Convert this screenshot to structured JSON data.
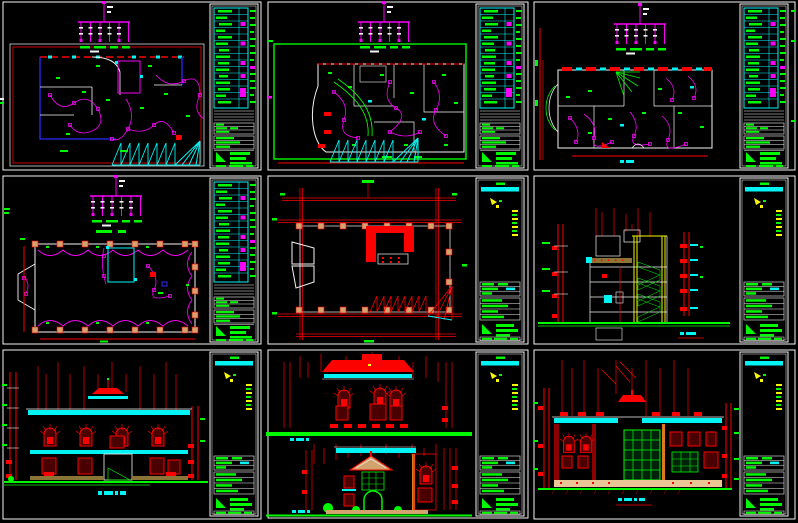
{
  "app": {
    "description": "Tiled preview of nine architectural CAD sheets (villa electrical plans, roof plan, section and elevations) on a black model-space background",
    "grid": {
      "rows": 3,
      "cols": 3,
      "cell_width": 266,
      "cell_height": 174
    }
  },
  "palette": {
    "background": "#000000",
    "white": "#f4f4f4",
    "red": "#fb0200",
    "green": "#00f800",
    "magenta": "#f800f8",
    "cyan": "#00f4f4",
    "blue": "#2a2aff",
    "yellow": "#f8f800",
    "tan": "#d2a36c",
    "peach": "#eac husband",
    "orange": "#e07820",
    "brown": "#8b7536",
    "gray": "#8f8f8f",
    "dark_red": "#8b0000",
    "brick_line": "#c04000",
    "window_dark": "#4a0000",
    "glass_dark": "#00220a"
  },
  "sheets": [
    {
      "id": "sheet-1",
      "row": 1,
      "col": 1,
      "drawing": "floor-lighting-plan-1",
      "title_block": "dense",
      "riser_diagram": true,
      "legend_rows": 15
    },
    {
      "id": "sheet-2",
      "row": 1,
      "col": 2,
      "drawing": "floor-lighting-plan-2",
      "title_block": "dense",
      "riser_diagram": true,
      "legend_rows": 15
    },
    {
      "id": "sheet-3",
      "row": 1,
      "col": 3,
      "drawing": "floor-lighting-plan-3",
      "title_block": "dense",
      "riser_diagram": true,
      "legend_rows": 15
    },
    {
      "id": "sheet-4",
      "row": 2,
      "col": 1,
      "drawing": "roof-lightning-protection-plan",
      "title_block": "dense",
      "riser_diagram": true,
      "legend_rows": 15
    },
    {
      "id": "sheet-5",
      "row": 2,
      "col": 2,
      "drawing": "roof-framing-plan",
      "title_block": "sparse",
      "riser_diagram": false
    },
    {
      "id": "sheet-6",
      "row": 2,
      "col": 3,
      "drawing": "building-section",
      "title_block": "sparse",
      "riser_diagram": false
    },
    {
      "id": "sheet-7",
      "row": 3,
      "col": 1,
      "drawing": "front-elevation",
      "title_block": "sparse",
      "riser_diagram": false
    },
    {
      "id": "sheet-8",
      "row": 3,
      "col": 2,
      "drawing": "side-elevations",
      "title_block": "sparse",
      "riser_diagram": false
    },
    {
      "id": "sheet-9",
      "row": 3,
      "col": 3,
      "drawing": "rear-elevation",
      "title_block": "sparse",
      "riser_diagram": false
    }
  ]
}
